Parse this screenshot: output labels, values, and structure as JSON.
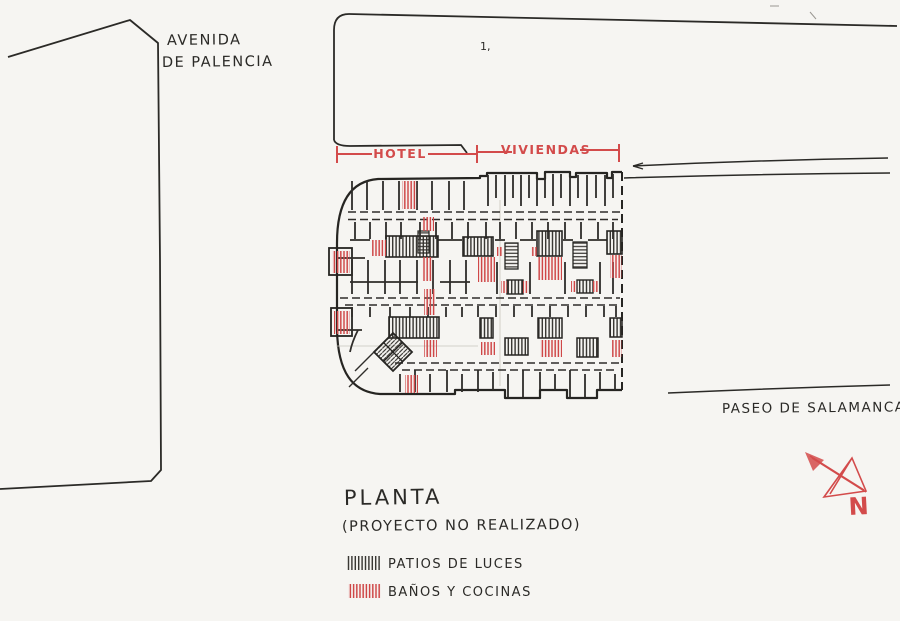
{
  "title": {
    "main": "PLANTA",
    "subtitle": "(PROYECTO NO REALIZADO)"
  },
  "streets": {
    "avenida_line1": "AVENIDA",
    "avenida_line2": "DE PALENCIA",
    "paseo": "PASEO DE SALAMANCA"
  },
  "sections": {
    "hotel": "HOTEL",
    "viviendas": "VIVIENDAS"
  },
  "legend": {
    "items": [
      {
        "label": "PATIOS DE LUCES",
        "swatch_color": "#2e2c29",
        "pattern": "vertical-hatch"
      },
      {
        "label": "BAÑOS Y COCINAS",
        "swatch_color": "#cc4040",
        "pattern": "vertical-hatch"
      }
    ]
  },
  "compass": {
    "label": "N",
    "color": "#d34b4b"
  },
  "stray_mark": {
    "text": "1,"
  },
  "colors": {
    "ink": "#2b2a27",
    "red_ink": "#d34b4b",
    "paper": "#f6f5f2"
  }
}
